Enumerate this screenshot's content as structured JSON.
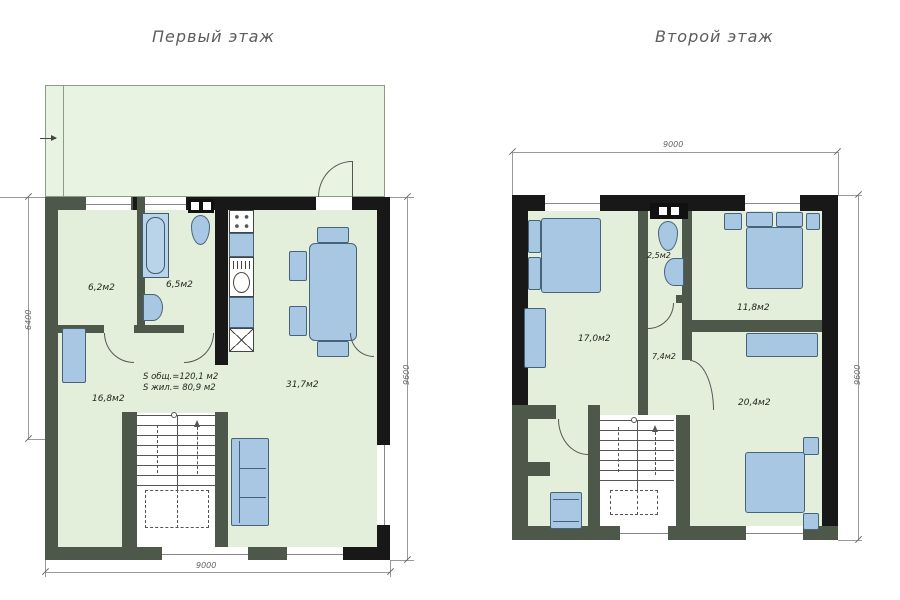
{
  "palette": {
    "wall": "#181818",
    "partition": "#4d584a",
    "floor": "#e3efdb",
    "furniture": "#a7c7e2",
    "furniture_outline": "#47627b",
    "dimension_line": "#9a9a9a"
  },
  "floor1": {
    "title": "Первый этаж",
    "rooms": {
      "bedroom": "6,2м2",
      "bathroom": "6,5м2",
      "living": "16,8м2",
      "kitchen_living": "31,7м2"
    },
    "area_total": "S общ.=120,1 м2",
    "area_living": "S жил.= 80,9 м2",
    "dim_left": "6400",
    "dim_right": "9600",
    "dim_bottom": "9000"
  },
  "floor2": {
    "title": "Второй этаж",
    "rooms": {
      "bedroom_17": "17,0м2",
      "wc": "2,5м2",
      "bedroom_11": "11,8м2",
      "hall": "7,4м2",
      "bedroom_20": "20,4м2"
    },
    "dim_top": "9000",
    "dim_right": "9600"
  }
}
